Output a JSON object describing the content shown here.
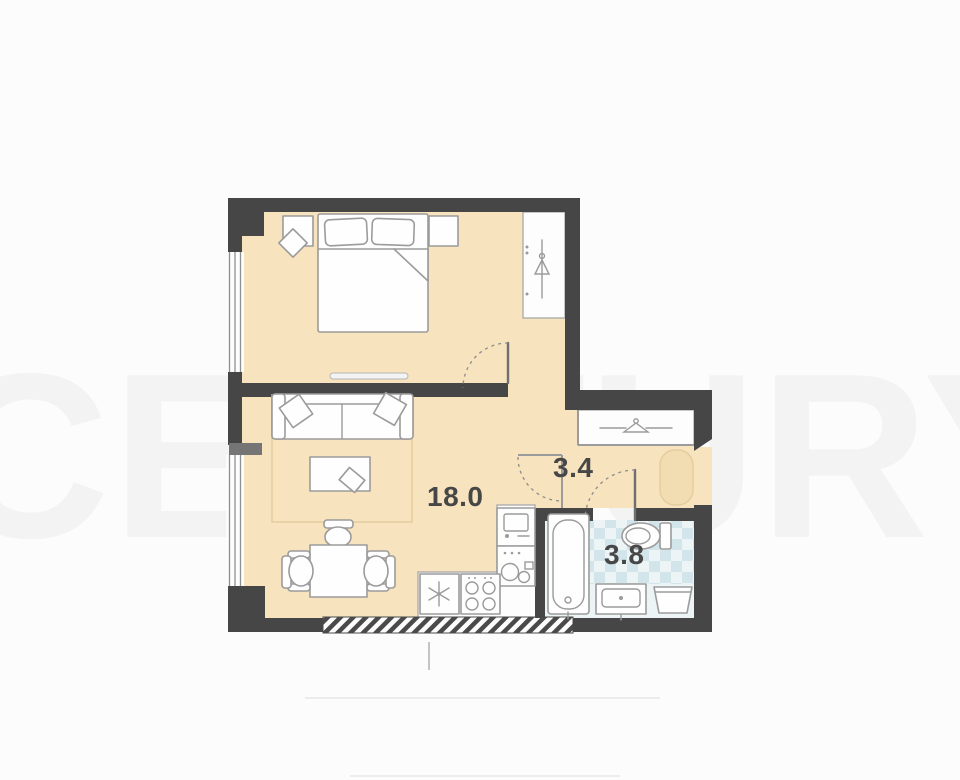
{
  "title": "apartment-floor-plan",
  "rooms": {
    "living": {
      "name": "living-room-with-kitchen",
      "area_m2": "18.0"
    },
    "hall": {
      "name": "hallway",
      "area_m2": "3.4"
    },
    "bath": {
      "name": "bathroom",
      "area_m2": "3.8"
    }
  },
  "watermark": {
    "text": "CENTURY"
  },
  "icons": {
    "fridge": "snowflake-icon",
    "hob": "four-burners-icon",
    "kitchen_sink": "double-bowl-sink-icon",
    "washer": "washing-machine-icon",
    "bedroom_wardrobe": "hanger-rail-icon",
    "hall_closet": "hanger-rail-icon",
    "bath_tub": "bathtub-icon",
    "toilet": "toilet-icon",
    "bath_sink": "washbasin-icon",
    "laundry_basket": "basket-icon"
  },
  "colors": {
    "wall": "#464646",
    "floor": "#f8e3bf",
    "tile": "#bcd9e0",
    "furniture_stroke": "#9b9b9b",
    "rug": "#f2ddb3",
    "label": "#474747",
    "background": "#fcfcfc"
  }
}
